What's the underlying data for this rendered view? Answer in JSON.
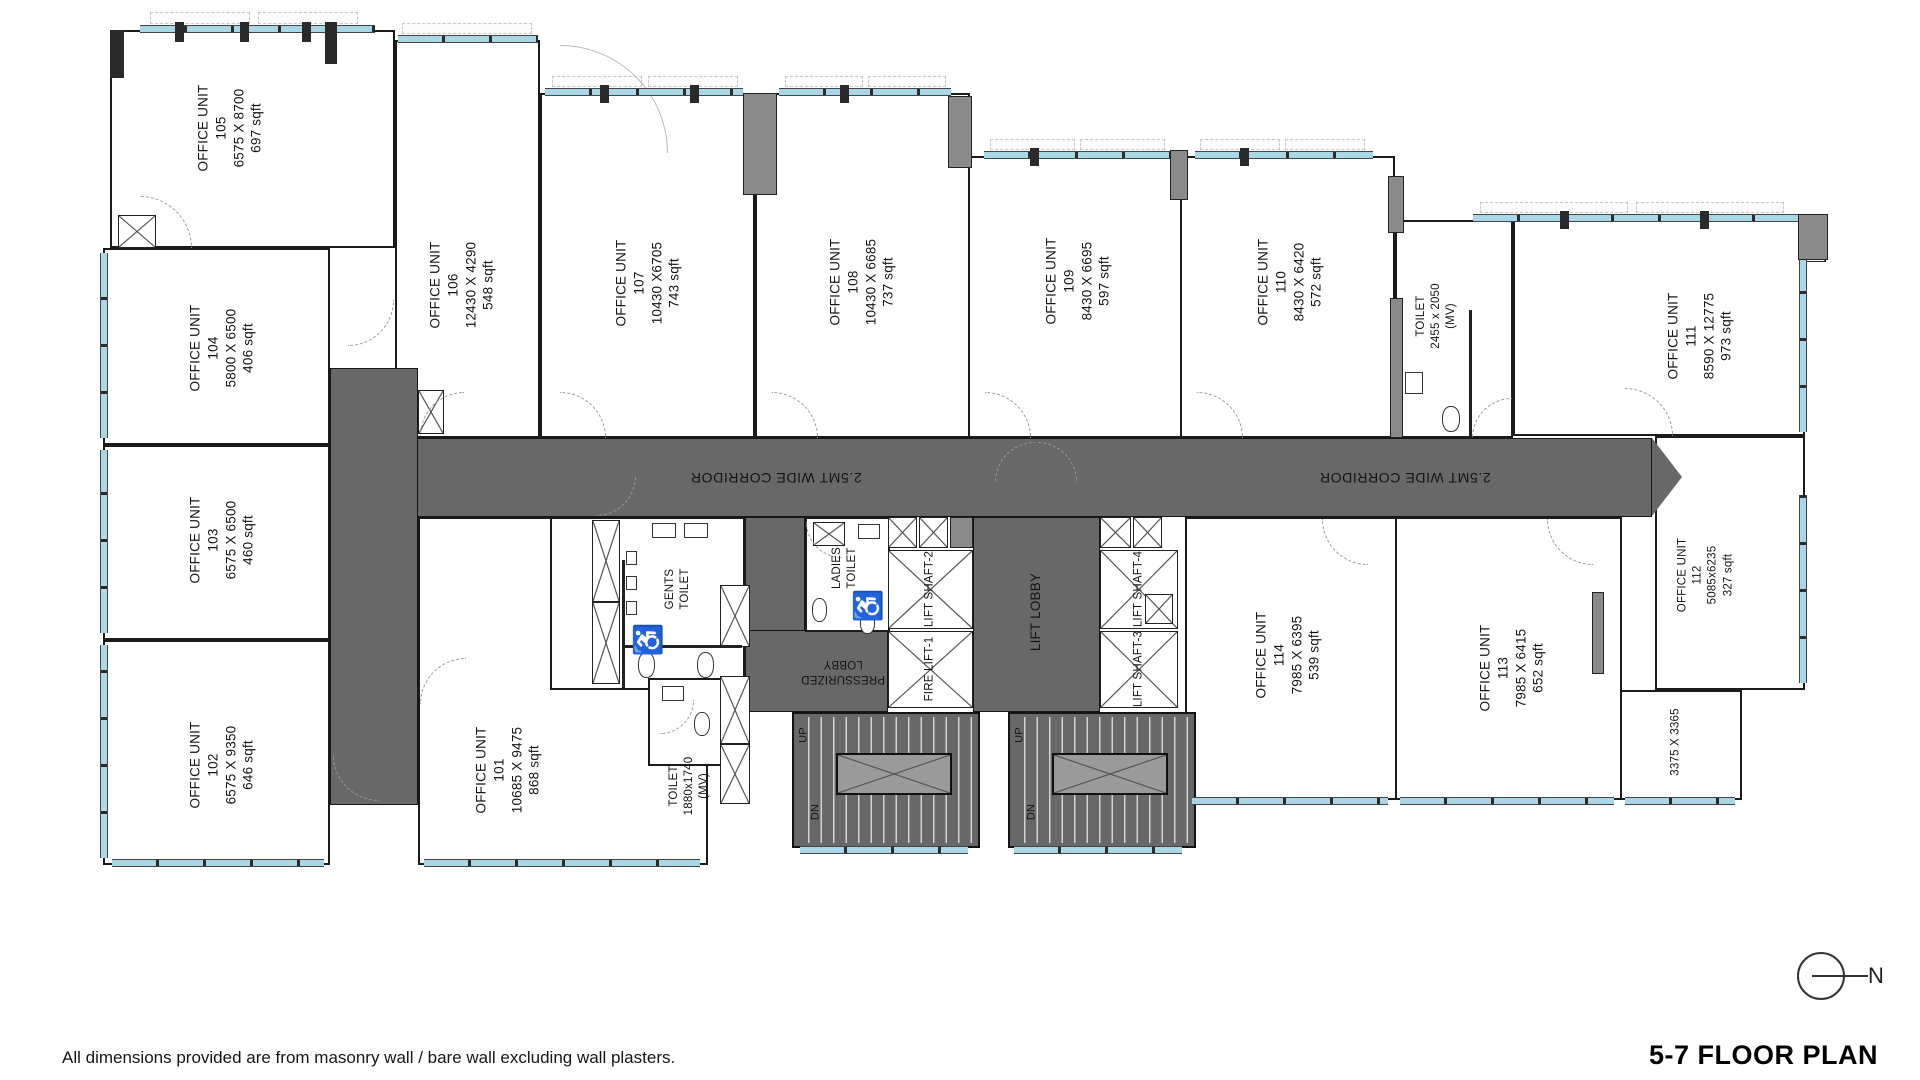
{
  "drawing": {
    "title": "5-7 FLOOR PLAN",
    "footnote": "All dimensions provided are from masonry wall / bare wall excluding wall plasters.",
    "north_label": "N"
  },
  "corridor": {
    "label_left": "2.5MT WIDE CORRIDOR",
    "label_right": "2.5MT WIDE CORRIDOR"
  },
  "units": {
    "u101": {
      "title": "OFFICE UNIT",
      "number": "101",
      "dims": "10685 X 9475",
      "area": "868 sqft"
    },
    "u102": {
      "title": "OFFICE UNIT",
      "number": "102",
      "dims": "6575 X 9350",
      "area": "646 sqft"
    },
    "u103": {
      "title": "OFFICE UNIT",
      "number": "103",
      "dims": "6575 X 6500",
      "area": "460 sqft"
    },
    "u104": {
      "title": "OFFICE UNIT",
      "number": "104",
      "dims": "5800 X 6500",
      "area": "406 sqft"
    },
    "u105": {
      "title": "OFFICE UNIT",
      "number": "105",
      "dims": "6575 X 8700",
      "area": "697 sqft"
    },
    "u106": {
      "title": "OFFICE UNIT",
      "number": "106",
      "dims": "12430 X 4290",
      "area": "548 sqft"
    },
    "u107": {
      "title": "OFFICE UNIT",
      "number": "107",
      "dims": "10430 X6705",
      "area": "743 sqft"
    },
    "u108": {
      "title": "OFFICE UNIT",
      "number": "108",
      "dims": "10430 X 6685",
      "area": "737 sqft"
    },
    "u109": {
      "title": "OFFICE UNIT",
      "number": "109",
      "dims": "8430 X 6695",
      "area": "597 sqft"
    },
    "u110": {
      "title": "OFFICE UNIT",
      "number": "110",
      "dims": "8430 X 6420",
      "area": "572 sqft"
    },
    "u111": {
      "title": "OFFICE UNIT",
      "number": "111",
      "dims": "8590 X 12775",
      "area": "973 sqft"
    },
    "u112": {
      "title": "OFFICE UNIT",
      "number": "112",
      "dims": "5085x6235",
      "area": "327 sqft"
    },
    "u113": {
      "title": "OFFICE UNIT",
      "number": "113",
      "dims": "7985 X 6415",
      "area": "652 sqft"
    },
    "u114": {
      "title": "OFFICE UNIT",
      "number": "114",
      "dims": "7985 X 6395",
      "area": "539 sqft"
    }
  },
  "rooms": {
    "toilet_top": {
      "title": "TOILET",
      "dims": "2455 x 2050",
      "note": "(MV)"
    },
    "toilet_bottom": {
      "title": "TOILET",
      "dims": "1880x1740",
      "note": "(MV)"
    },
    "gents_toilet": {
      "line1": "GENTS",
      "line2": "TOILET"
    },
    "ladies_toilet": {
      "line1": "LADIES",
      "line2": "TOILET"
    },
    "pressurized_lobby": {
      "line1": "PRESSURIZED",
      "line2": "LOBBY"
    },
    "lift_lobby": {
      "label": "LIFT LOBBY"
    },
    "fire_lift_1": {
      "label": "FIRE LIFT-1"
    },
    "lift_shaft_2": {
      "label": "LIFT SHAFT-2"
    },
    "lift_shaft_3": {
      "label": "LIFT SHAFT-3"
    },
    "lift_shaft_4": {
      "label": "LIFT SHAFT-4"
    },
    "store_small": {
      "dims": "3375 X 3365"
    }
  },
  "stairs": {
    "up": "UP",
    "down": "DN"
  },
  "symbols": {
    "accessible": "♿"
  },
  "colors": {
    "corridor_fill": "#686868",
    "wall": "#1b1b1b",
    "column_fill": "#8a8a8a",
    "glazing": "#a9d7e8",
    "accessible": "#1a99d6"
  }
}
